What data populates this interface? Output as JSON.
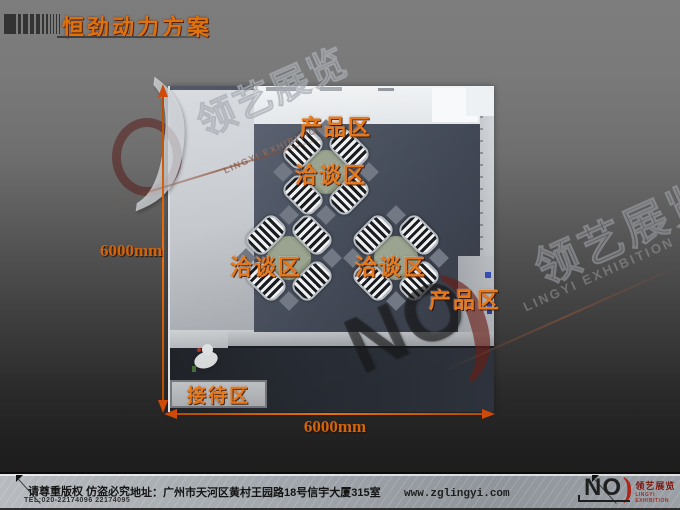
{
  "header": {
    "title": "恒劲动力方案"
  },
  "plan": {
    "zones": [
      {
        "id": "product-top",
        "label": "产品区"
      },
      {
        "id": "meeting-1",
        "label": "洽谈区"
      },
      {
        "id": "meeting-2",
        "label": "洽谈区"
      },
      {
        "id": "meeting-3",
        "label": "洽谈区"
      },
      {
        "id": "product-right",
        "label": "产品区"
      },
      {
        "id": "reception",
        "label": "接待区"
      }
    ],
    "dim_height": "6000mm",
    "dim_width": "6000mm"
  },
  "watermark": {
    "brand_no": "NO",
    "brand_paren": ")",
    "brand_cn": "领艺展览",
    "brand_en": "LINGYI EXHIBITION"
  },
  "footer": {
    "copyright": "请尊重版权 仿盗必究",
    "tel": "TEL:020-22174096 22174095",
    "address": "地址：广州市天河区黄村王园路18号信宇大厦315室",
    "website": "www.zglingyi.com",
    "logo": {
      "no": "NO",
      "paren": ")",
      "cn": "领艺展览",
      "en": "LINGYI EXHIBITION"
    }
  },
  "colors": {
    "accent_orange": "#e8791a",
    "dimension_orange": "#d2650c",
    "carpet_blue": "#49505e",
    "logo_red": "#b02418",
    "background_gray": "#7d7d7d"
  }
}
